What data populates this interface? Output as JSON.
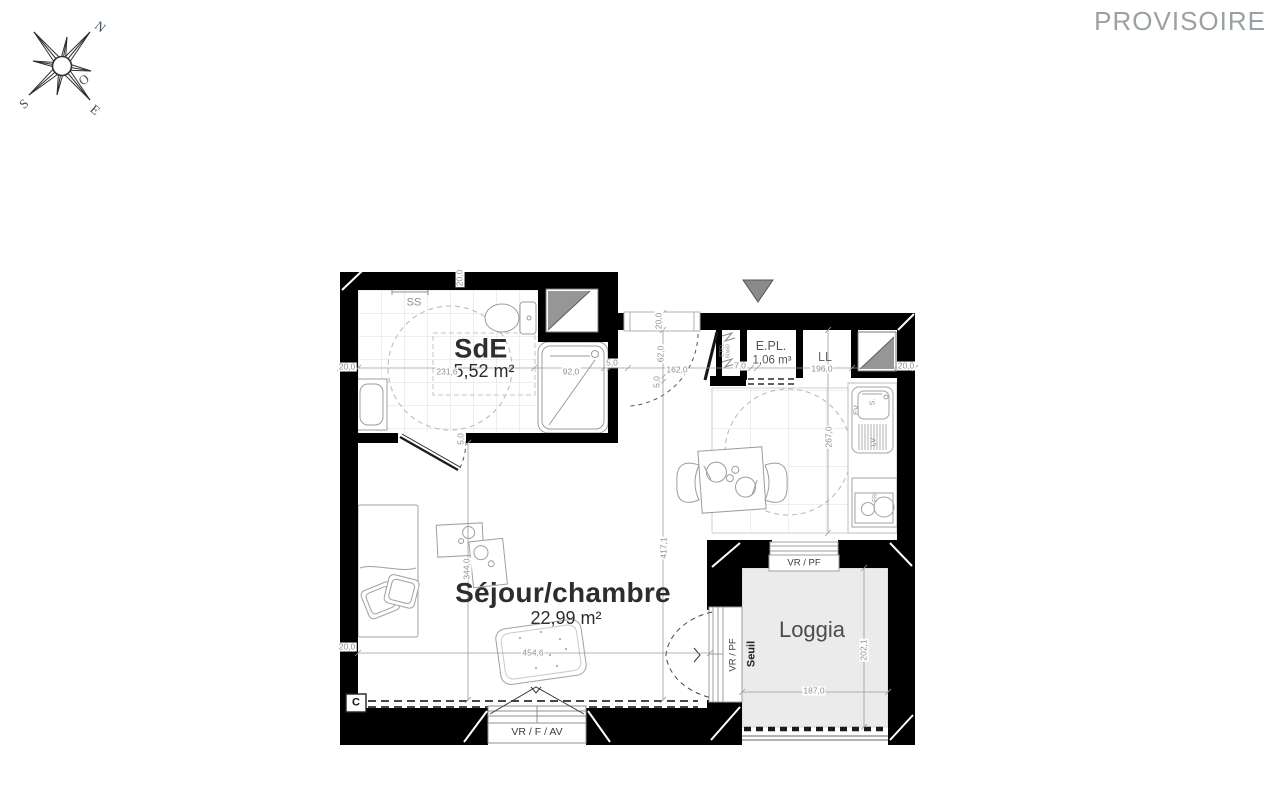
{
  "watermark": "PROVISOIRE",
  "compass": {
    "west": "O",
    "north": "N",
    "south": "S",
    "east": "E"
  },
  "rooms": {
    "sde": {
      "name": "SdE",
      "area": "5,52 m²"
    },
    "sejour": {
      "name": "Séjour/chambre",
      "area": "22,99 m²"
    },
    "loggia": {
      "name": "Loggia"
    },
    "epl": {
      "name": "E.PL.",
      "volume": "1,06 m³"
    },
    "ll": {
      "name": "LL"
    }
  },
  "fixtures": {
    "towel_rail": "SS",
    "sink": "EV",
    "basin": "S.",
    "dishwasher": "LV",
    "fridge": "FRI",
    "shaft": "ETEL",
    "shaft_size": "60x60",
    "convector": "C"
  },
  "openings": {
    "loggia_window": "VR / PF",
    "loggia_door": "VR / PF",
    "threshold": "Seuil",
    "sejour_window": "VR / F / AV"
  },
  "dimensions": {
    "wall_top": "20,0",
    "sde_left": "20,0",
    "sde_width": "231,6",
    "shower_width": "92,0",
    "shower_gap": "5,0",
    "hall_width": "162,0",
    "shaft_width": "7,0",
    "kitchen_width": "196,0",
    "wall_right": "20,0",
    "hall_top": "20,0",
    "entry_depth": "62,0",
    "hall_gap": "5,0",
    "sejour_depth": "417,1",
    "sde_door_gap": "5,0",
    "sejour_height": "344,0",
    "kitchen_depth": "267,0",
    "sejour_width": "454,6",
    "sejour_left": "20,0",
    "loggia_width": "187,0",
    "loggia_depth": "202,1"
  }
}
